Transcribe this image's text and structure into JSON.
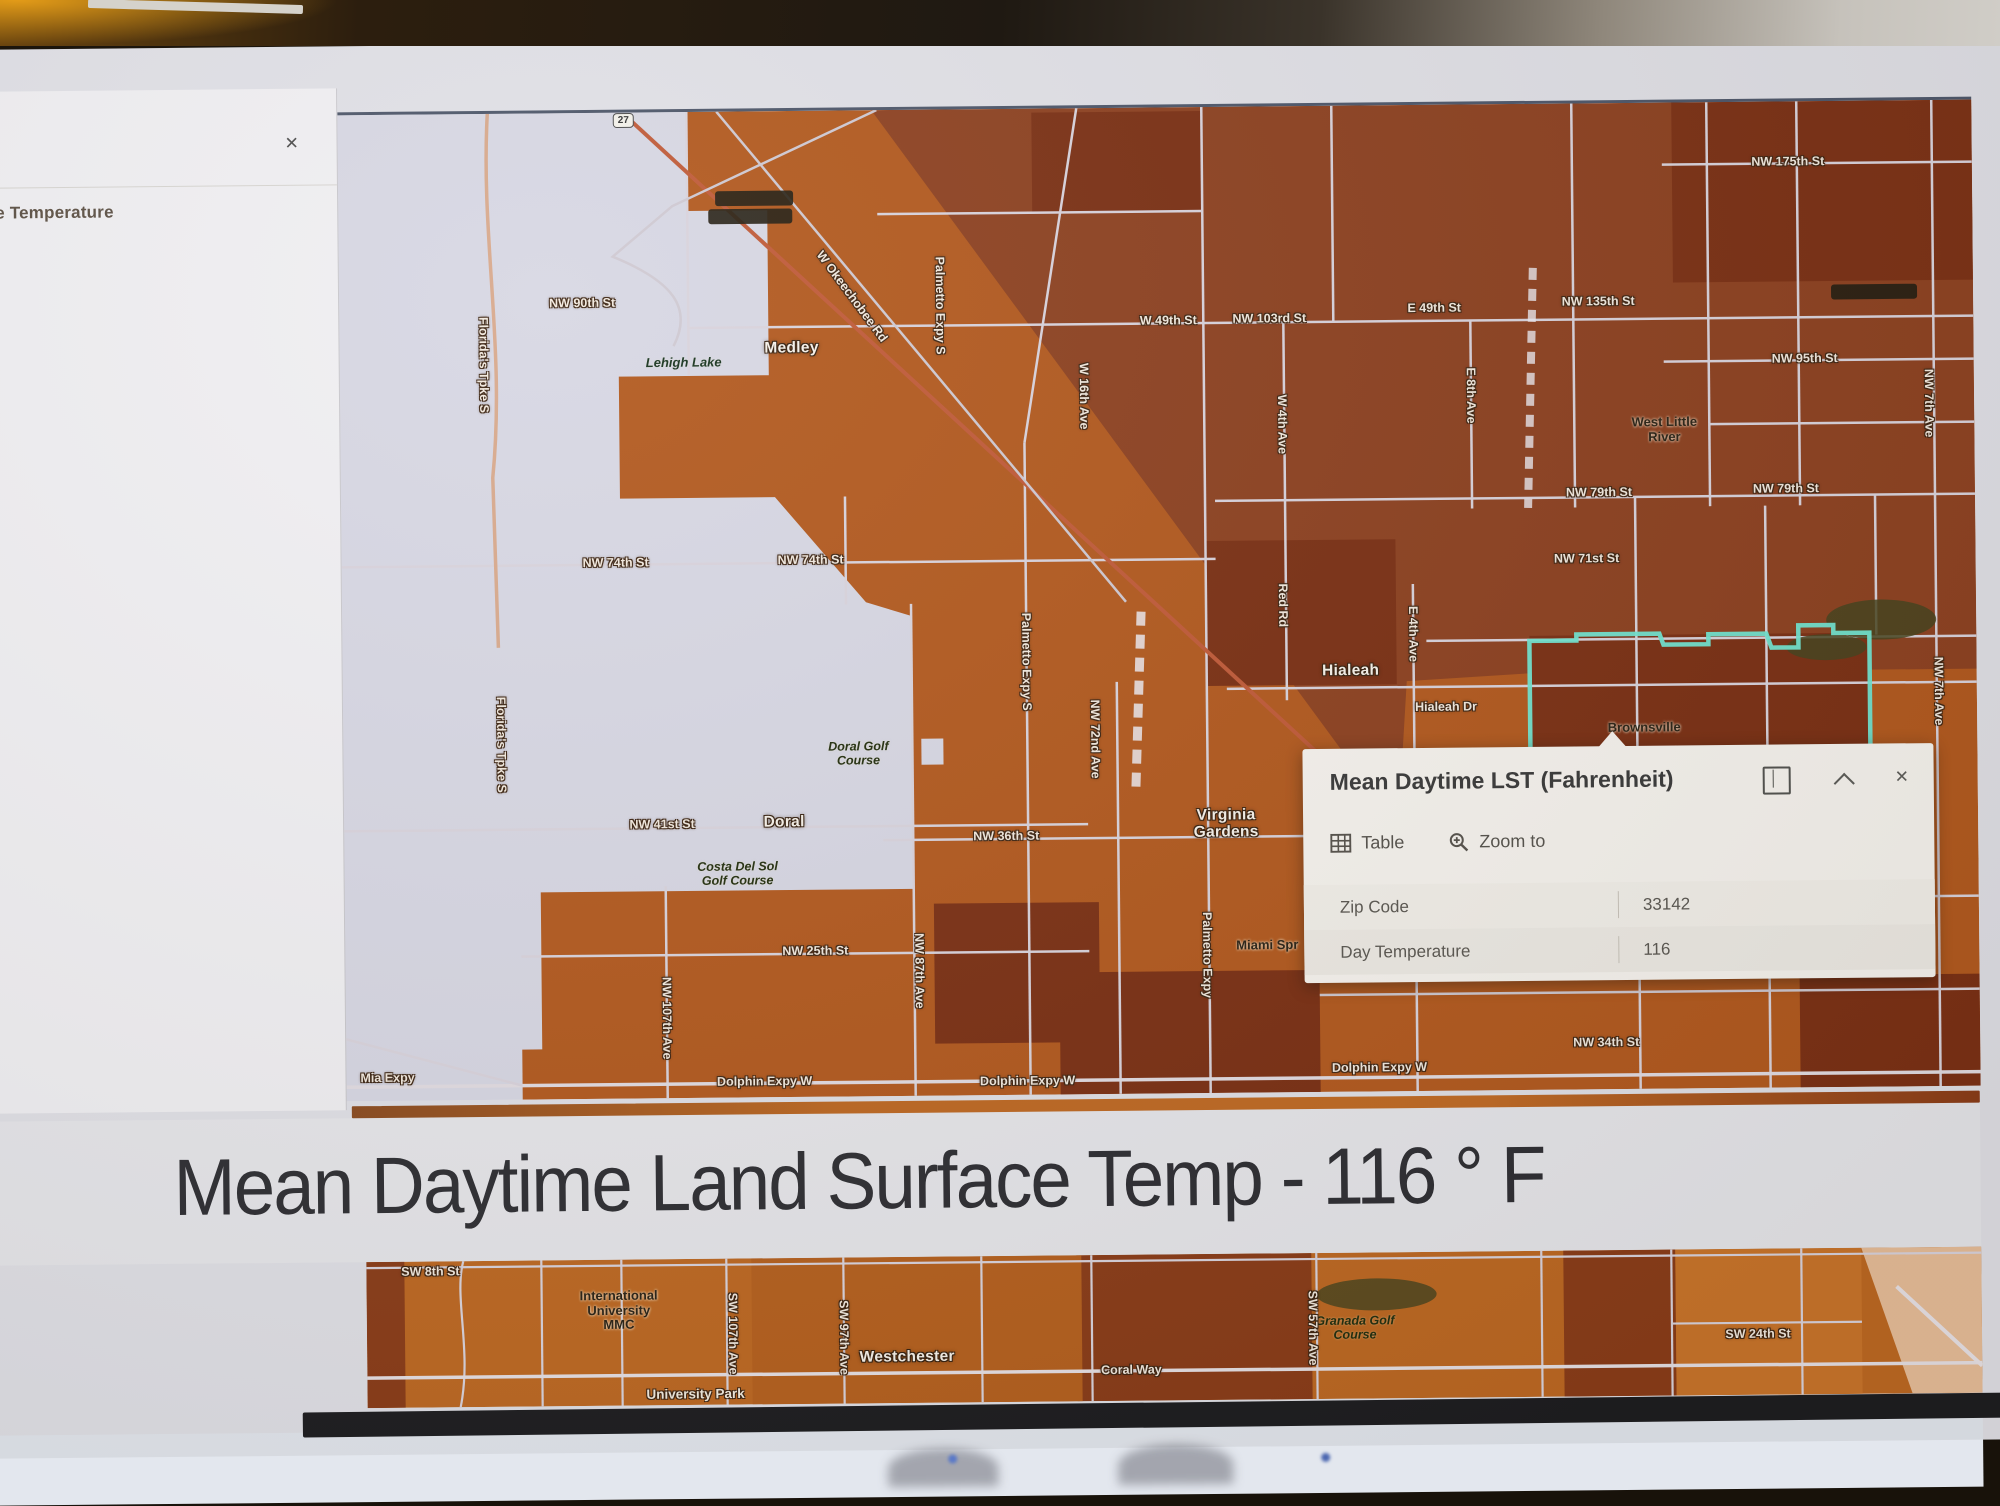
{
  "sidebar": {
    "title": "rface Temperature",
    "close_glyph": "✕"
  },
  "popup": {
    "title": "Mean Daytime LST (Fahrenheit)",
    "window": {
      "close_glyph": "✕"
    },
    "actions": [
      {
        "icon": "table-icon",
        "label": "Table"
      },
      {
        "icon": "zoom-to-icon",
        "label": "Zoom to"
      }
    ],
    "fields": [
      {
        "label": "Zip Code",
        "value": "33142"
      },
      {
        "label": "Day Temperature",
        "value": "116"
      }
    ]
  },
  "headline": {
    "text": "Mean Daytime Land Surface Temp - 116 ° F"
  },
  "colors": {
    "selection_outline": "#72e6d2",
    "map_orange": "#b2591e",
    "map_dark_brown": "#7b3014",
    "map_nodata": "#d7d7e3",
    "popup_bg": "#f6f3ee"
  },
  "map": {
    "labels": [
      {
        "text": "NW 90th St",
        "x": 610,
        "y": 259,
        "kind": "street"
      },
      {
        "text": "W 49th St",
        "x": 1196,
        "y": 282,
        "kind": "street"
      },
      {
        "text": "NW 103rd St",
        "x": 1297,
        "y": 281,
        "kind": "street"
      },
      {
        "text": "E 49th St",
        "x": 1462,
        "y": 272,
        "kind": "street"
      },
      {
        "text": "NW 135th St",
        "x": 1626,
        "y": 267,
        "kind": "street"
      },
      {
        "text": "NW 175th St",
        "x": 1817,
        "y": 129,
        "kind": "street"
      },
      {
        "text": "NW 95th St",
        "x": 1832,
        "y": 326,
        "kind": "street"
      },
      {
        "text": "NW 79th St",
        "x": 1625,
        "y": 458,
        "kind": "street"
      },
      {
        "text": "NW 79th St",
        "x": 1812,
        "y": 456,
        "kind": "street"
      },
      {
        "text": "NW 74th St",
        "x": 641,
        "y": 519,
        "kind": "street"
      },
      {
        "text": "NW 74th St",
        "x": 836,
        "y": 518,
        "kind": "street"
      },
      {
        "text": "NW 71st St",
        "x": 1612,
        "y": 524,
        "kind": "street"
      },
      {
        "text": "Hialeah Dr",
        "x": 1470,
        "y": 671,
        "kind": "street"
      },
      {
        "text": "NW 41st St",
        "x": 685,
        "y": 781,
        "kind": "street"
      },
      {
        "text": "NW 36th St",
        "x": 1029,
        "y": 796,
        "kind": "street"
      },
      {
        "text": "NW 25th St",
        "x": 837,
        "y": 909,
        "kind": "street"
      },
      {
        "text": "NW 34th St",
        "x": 1627,
        "y": 1008,
        "kind": "street"
      },
      {
        "text": "Dolphin Expy W",
        "x": 785,
        "y": 1039,
        "kind": "street"
      },
      {
        "text": "Dolphin Expy W",
        "x": 1048,
        "y": 1041,
        "kind": "street"
      },
      {
        "text": "Dolphin Expy W",
        "x": 1400,
        "y": 1031,
        "kind": "street"
      },
      {
        "text": "Mia Expy",
        "x": 408,
        "y": 1032,
        "kind": "street"
      },
      {
        "text": "W Okeechobee Rd",
        "x": 880,
        "y": 255,
        "kind": "street",
        "rot": 54
      },
      {
        "text": "Florida's Tpke S",
        "x": 511,
        "y": 320,
        "kind": "street-v"
      },
      {
        "text": "Florida's Tpke S",
        "x": 525,
        "y": 700,
        "kind": "street-v"
      },
      {
        "text": "NW 107th Ave",
        "x": 688,
        "y": 975,
        "kind": "street-v"
      },
      {
        "text": "NW 87th Ave",
        "x": 941,
        "y": 930,
        "kind": "street-v"
      },
      {
        "text": "Palmetto Expy S",
        "x": 968,
        "y": 265,
        "kind": "street-v"
      },
      {
        "text": "Palmetto Expy S",
        "x": 1051,
        "y": 622,
        "kind": "street-v"
      },
      {
        "text": "NW 72nd Ave",
        "x": 1119,
        "y": 700,
        "kind": "street-v"
      },
      {
        "text": "Palmetto Expy",
        "x": 1229,
        "y": 917,
        "kind": "street-v"
      },
      {
        "text": "W 16th Ave",
        "x": 1111,
        "y": 357,
        "kind": "street-v"
      },
      {
        "text": "W 4th Ave",
        "x": 1309,
        "y": 387,
        "kind": "street-v"
      },
      {
        "text": "Red Rd",
        "x": 1308,
        "y": 568,
        "kind": "street-v"
      },
      {
        "text": "E 4th Ave",
        "x": 1438,
        "y": 598,
        "kind": "street-v"
      },
      {
        "text": "E 8th Ave",
        "x": 1498,
        "y": 360,
        "kind": "street-v"
      },
      {
        "text": "NW 7th Ave",
        "x": 1956,
        "y": 372,
        "kind": "street-v"
      },
      {
        "text": "NW 7th Ave",
        "x": 1963,
        "y": 660,
        "kind": "street-v"
      },
      {
        "text": "Medley",
        "x": 819,
        "y": 306,
        "kind": "place"
      },
      {
        "text": "Hialeah",
        "x": 1375,
        "y": 634,
        "kind": "place"
      },
      {
        "text": "Doral",
        "x": 807,
        "y": 780,
        "kind": "place"
      },
      {
        "text": "Virginia\nGardens",
        "x": 1249,
        "y": 786,
        "kind": "place"
      },
      {
        "text": "West Little\nRiver",
        "x": 1691,
        "y": 396,
        "kind": "dark"
      },
      {
        "text": "Brownsville",
        "x": 1668,
        "y": 694,
        "kind": "dark"
      },
      {
        "text": "Miami Spr",
        "x": 1289,
        "y": 908,
        "kind": "dark"
      },
      {
        "text": "Lehigh Lake",
        "x": 711,
        "y": 320,
        "kind": "water"
      },
      {
        "text": "Doral Golf\nCourse",
        "x": 882,
        "y": 712,
        "kind": "park"
      },
      {
        "text": "Costa Del Sol\nGolf Course",
        "x": 760,
        "y": 831,
        "kind": "park"
      },
      {
        "text": "27",
        "x": 653,
        "y": 77,
        "kind": "shield"
      },
      {
        "x": 783,
        "y": 156,
        "w": 78,
        "h": 15,
        "kind": "pill"
      },
      {
        "x": 779,
        "y": 174,
        "w": 84,
        "h": 15,
        "kind": "pill"
      },
      {
        "x": 1902,
        "y": 260,
        "w": 86,
        "h": 15,
        "kind": "pill"
      }
    ]
  },
  "strip": {
    "labels": [
      {
        "text": "SW 8th St",
        "x": 449,
        "y": 1226,
        "kind": "street"
      },
      {
        "text": "International\nUniversity\nMMC",
        "x": 637,
        "y": 1267,
        "kind": "dark"
      },
      {
        "text": "Westchester",
        "x": 925,
        "y": 1316,
        "kind": "place"
      },
      {
        "text": "University Park",
        "x": 713,
        "y": 1351,
        "kind": "place-sm"
      },
      {
        "text": "Granada Golf\nCourse",
        "x": 1373,
        "y": 1291,
        "kind": "park"
      },
      {
        "text": "Coral Way",
        "x": 1149,
        "y": 1331,
        "kind": "street"
      },
      {
        "text": "SW 24th St",
        "x": 1776,
        "y": 1301,
        "kind": "street"
      },
      {
        "text": "SW 107th Ave",
        "x": 751,
        "y": 1291,
        "kind": "street-v"
      },
      {
        "text": "SW 97th Ave",
        "x": 862,
        "y": 1296,
        "kind": "street-v"
      },
      {
        "text": "SW 57th Ave",
        "x": 1331,
        "y": 1291,
        "kind": "street-v"
      }
    ]
  }
}
